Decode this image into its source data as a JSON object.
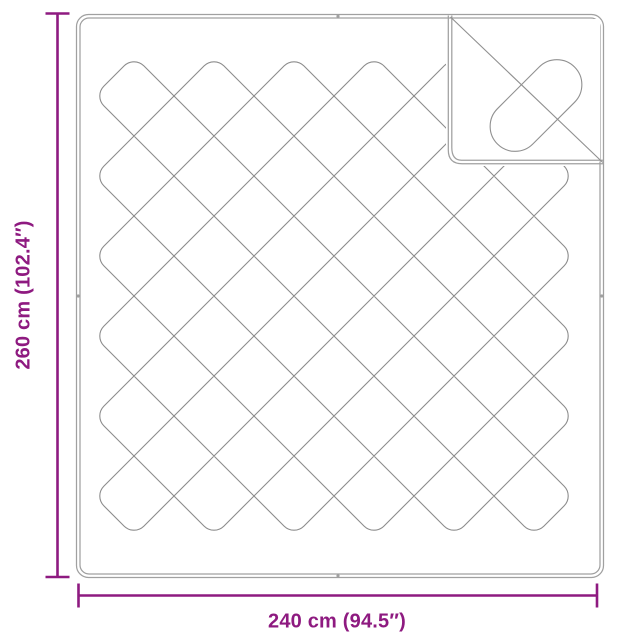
{
  "diagram": {
    "height_label": "260 cm (102.4″)",
    "width_label": "240 cm (94.5″)"
  },
  "colors": {
    "dimension_accent": "#8E1A80",
    "outline_gray": "#A0A0A0",
    "stitch_gray": "#8C8C8C",
    "background": "#FFFFFF"
  }
}
